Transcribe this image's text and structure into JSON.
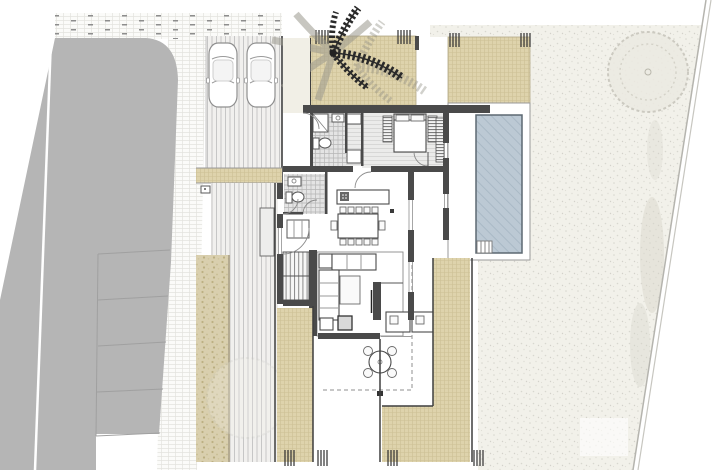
{
  "meta": {
    "view": "site-plan-ground-floor",
    "has_text_labels": false
  },
  "colors": {
    "background": "#ffffff",
    "road": "#b5b5b5",
    "road_stall_line": "#a0a0a0",
    "sidewalk": "#fbfbf9",
    "sidewalk_line": "#e4e3df",
    "deck": "#f1f0ee",
    "deck_stripe": "#c6c6c6",
    "beige": "#ded3ac",
    "beige_line": "#cdc095",
    "hedge": "#d9cfae",
    "hedge_dot": "#bdb083",
    "gravel": "#f2f1ea",
    "gravel_dot": "#d8d7cf",
    "wall": "#4a4a4a",
    "pool_water": "#bcc9d4",
    "pool_hatch": "#a7b7c5",
    "pool_border": "#5d6872",
    "tile": "#e4e4e4",
    "tile_line": "#b6b6b6",
    "floor_stripe_bg": "#ebebea",
    "floor_stripe": "#d7d7d6",
    "hatch_block": "#6e6e6e",
    "palm_dark": "#2a2a2a",
    "palm_shadow": "#9b998e",
    "tree_outline": "#c6c4ba",
    "tree_fill": "#eceae2",
    "boundary": "#b5b4ae",
    "entry_walkway": "#f1efe6"
  },
  "inventory": {
    "vehicles": {
      "cars": 2
    },
    "vegetation": {
      "palm_trees": 1,
      "canopy_trees": 2,
      "hedge_strips": 3
    },
    "pool": {
      "present": true,
      "ladder": true
    },
    "parking": {
      "stall_divider_lines": 5
    },
    "house_rooms": [
      "entry-walkway",
      "bathroom",
      "hallway",
      "bedroom",
      "wc",
      "kitchen",
      "dining-area",
      "living-room",
      "stairs",
      "covered-terrace"
    ],
    "furniture": {
      "beds": 1,
      "kitchen_islands": 1,
      "dining_chairs": 12,
      "terrace_chairs": 4,
      "sofas": 2,
      "coffee_tables": 1,
      "tv_wall_units": 1,
      "outdoor_kitchen_units": 2
    }
  }
}
